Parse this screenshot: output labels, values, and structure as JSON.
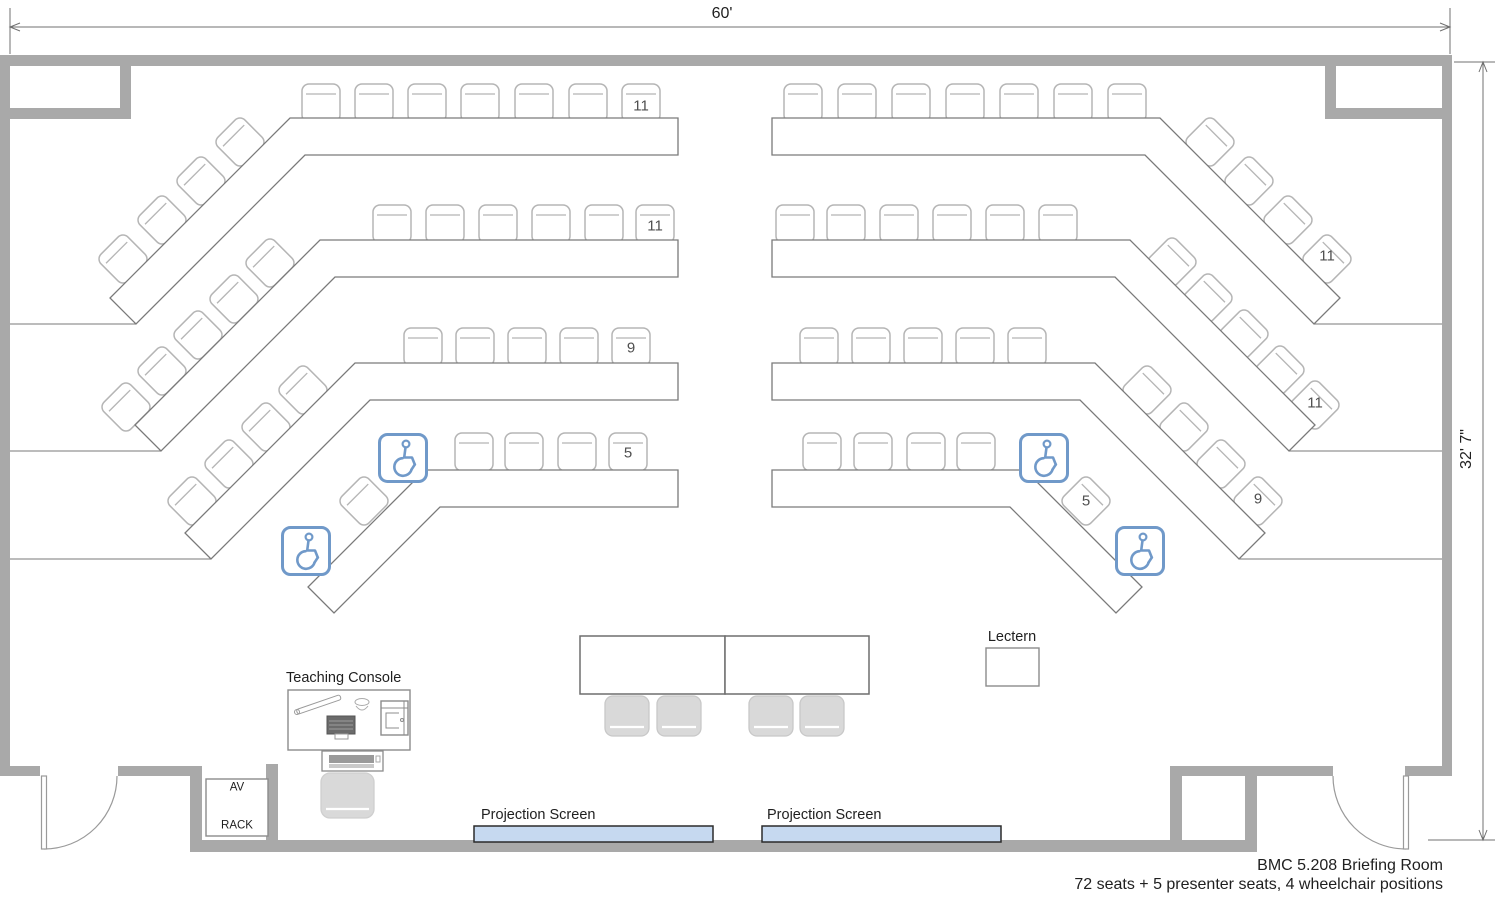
{
  "room": {
    "title_line1": "BMC 5.208 Briefing Room",
    "title_line2": "72 seats + 5 presenter seats, 4 wheelchair positions",
    "width_label": "60'",
    "depth_label": "32' 7\""
  },
  "labels": {
    "teaching_console": "Teaching Console",
    "lectern": "Lectern",
    "av_rack_line1": "AV",
    "av_rack_line2": "RACK",
    "projection_screen_left": "Projection Screen",
    "projection_screen_right": "Projection Screen"
  },
  "seating": {
    "left_rows": [
      {
        "row": 1,
        "seats": "11"
      },
      {
        "row": 2,
        "seats": "11"
      },
      {
        "row": 3,
        "seats": "9"
      },
      {
        "row": 4,
        "seats": "5"
      }
    ],
    "right_rows": [
      {
        "row": 1,
        "seats": "11"
      },
      {
        "row": 2,
        "seats": "11"
      },
      {
        "row": 3,
        "seats": "9"
      },
      {
        "row": 4,
        "seats": "5"
      }
    ],
    "wheelchair_positions": 4,
    "presenter_seats": 5,
    "total_audience_seats": 72
  },
  "colors": {
    "wall": "#a9a9a9",
    "table_stroke": "#7a7a7a",
    "chair_stroke": "#b5b5b5",
    "presenter_chair_fill": "#d9d9d9",
    "screen_fill": "#c6d9f0",
    "screen_stroke": "#2b2b2b",
    "accessible_blue": "#7099c9",
    "dim_line": "#707070",
    "text": "#1f1f1f",
    "seat_number": "#4f4f4f"
  }
}
